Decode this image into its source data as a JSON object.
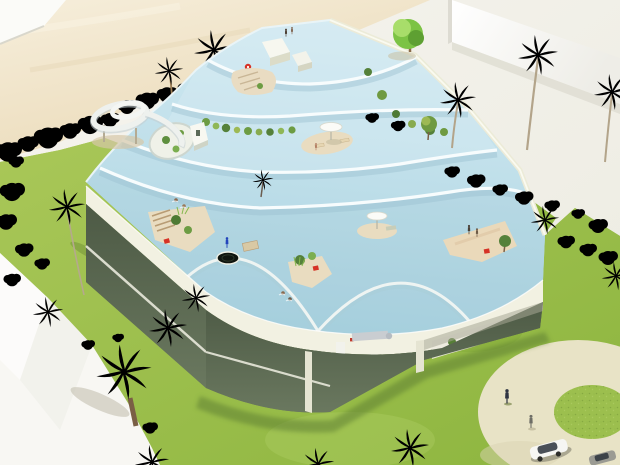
{
  "scene": {
    "type": "3d-architectural-rendering",
    "description": "Aerial rendering of a terraced building whose stepped rooftops are covered by cascading swimming-pool water terraces, with a spiral water slide, sandy rooftop islands, parasols, a trampoline and red deck chairs; a two-storey glass facade below; surrounded by a sandy beach, lawns, palm trees, hedges, a white boundary wall, white paved paths, a circular plaza with a grass ring, pedestrians and a parked car.",
    "width_px": 620,
    "height_px": 465
  },
  "palette": {
    "sand_light": "#f6eedb",
    "sand_dark": "#ead9b6",
    "pavement": "#f2f0e8",
    "path_white": "#f8f7f3",
    "wall_white": "#fbfbf8",
    "lawn_light": "#a9c758",
    "lawn_dark": "#8db53f",
    "water_light": "#d2eaf2",
    "water_dark": "#a9d2e0",
    "rim_white": "#f7fcfd",
    "rim_shadow": "#9cc2d1",
    "fascia_cream": "#f2f1e2",
    "fascia_under": "#c9c9b4",
    "steps_cream": "#ecebd8",
    "island_sand": "#e9dcc0",
    "red_accent": "#d63226",
    "parasol_white": "#fbfbf7",
    "slide_white": "#eef1ee",
    "trampoline_black": "#10150f",
    "glass_dark": "#4d5a45",
    "plaza_beige": "#e8e3c6",
    "plaza_grass": "#9cbf4e",
    "car_white": "#f6f6f3",
    "car_grey": "#9b9b93",
    "duct_silver": "#c9cdd1"
  },
  "building": {
    "water_terrace_levels": 5,
    "rooftop_features": [
      "pool deck",
      "spiral water slide",
      "white parasols",
      "sandy islands with plants",
      "trampoline",
      "timber stair island",
      "red deck chairs",
      "white stair boxes",
      "oval light-well courtyard",
      "planting strip",
      "red lifebuoy"
    ],
    "facade": {
      "stories_visible": 2,
      "material": "full-height glazing with dark mullions",
      "interior": [
        "dining table and chairs",
        "potted plants",
        "white kitchen counter",
        "ventilation duct",
        "people"
      ]
    }
  },
  "landscape": {
    "elements": [
      "sandy beach",
      "lawns",
      "palm trees",
      "clipped hedges",
      "round tree",
      "white boundary wall",
      "white paved paths",
      "circular plaza with grass ring"
    ],
    "figures": {
      "swimmers": 6,
      "sunbathers": 4,
      "pedestrians": 2,
      "cars": 2
    }
  }
}
